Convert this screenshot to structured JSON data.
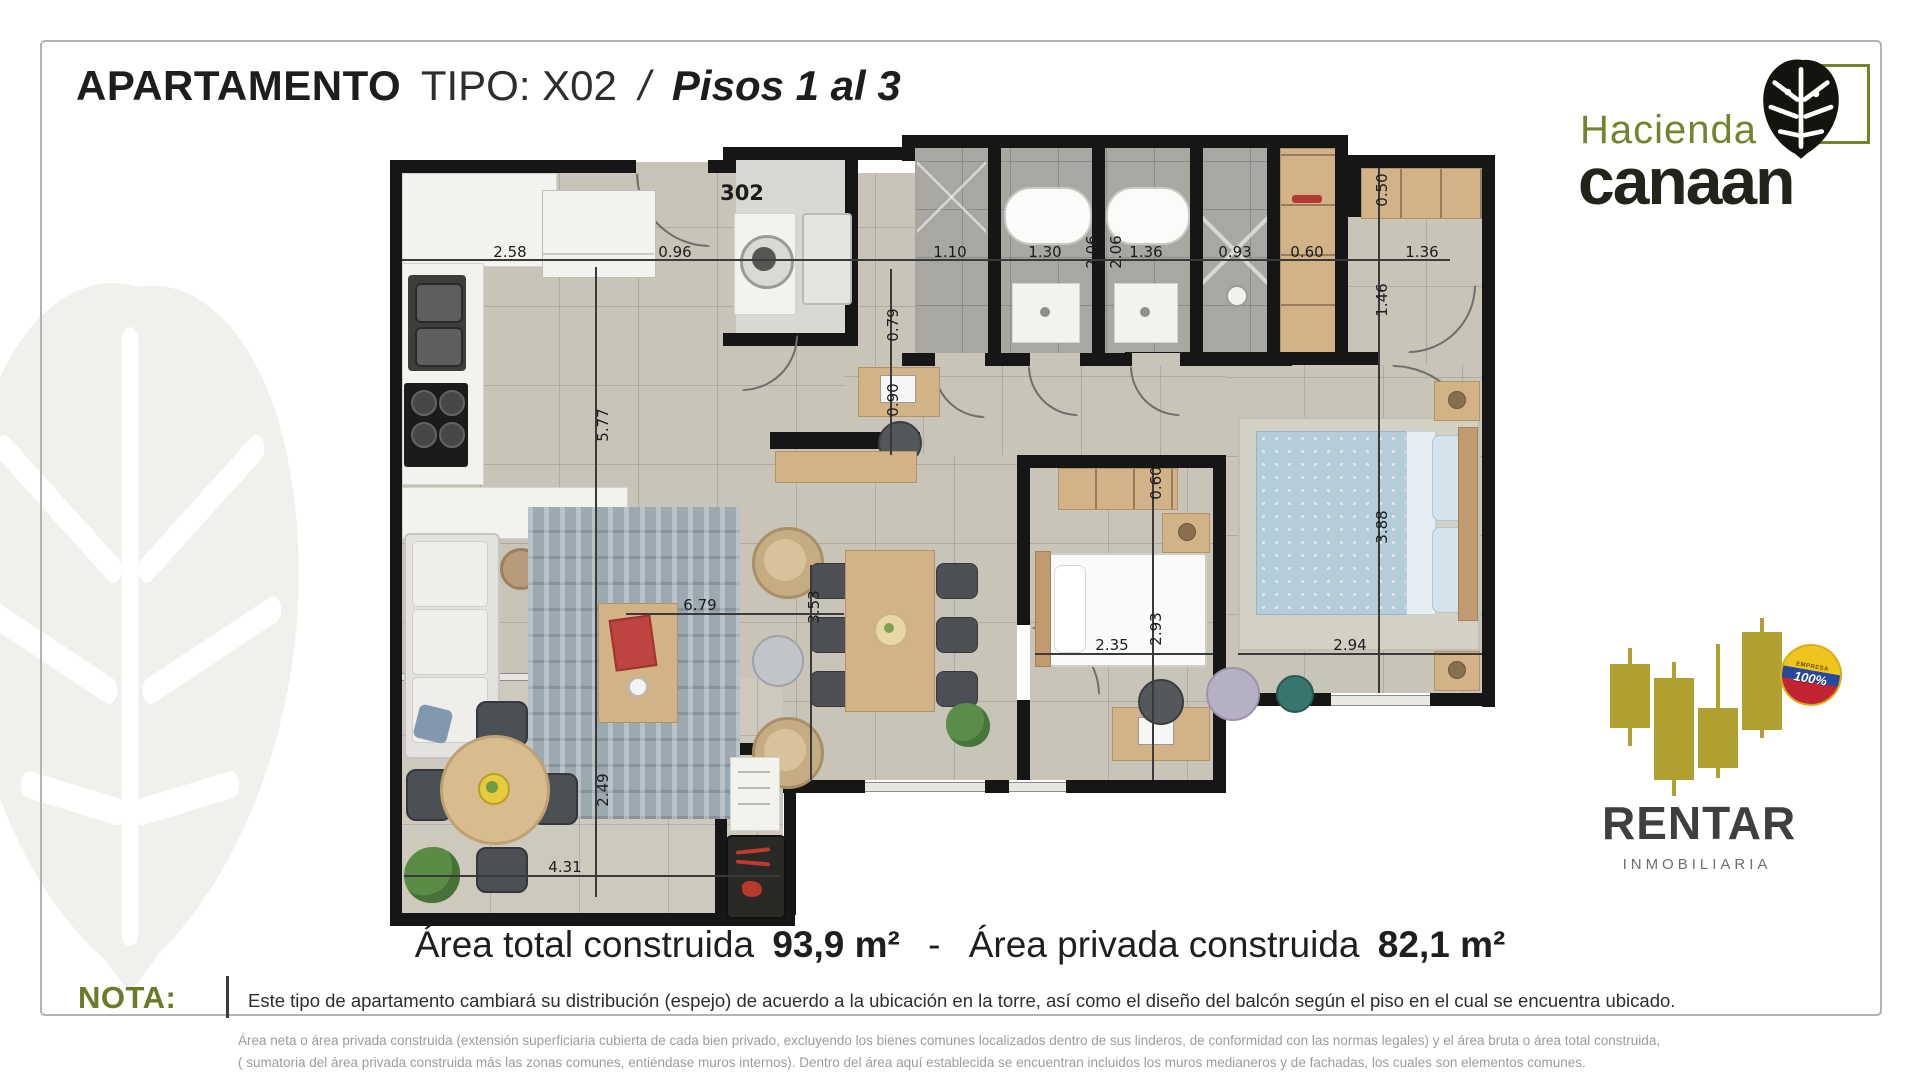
{
  "header": {
    "title_main": "APARTAMENTO",
    "title_type": "TIPO: X02",
    "title_sep": "/",
    "title_floors": "Pisos 1 al 3"
  },
  "brand": {
    "name_top": "Hacienda",
    "name_bottom": "canaan"
  },
  "plan": {
    "unit_label": "302",
    "dims": [
      {
        "v": "2.58"
      },
      {
        "v": "0.96"
      },
      {
        "v": "1.10"
      },
      {
        "v": "1.30"
      },
      {
        "v": "2.06"
      },
      {
        "v": "2.06"
      },
      {
        "v": "1.36"
      },
      {
        "v": "0.93"
      },
      {
        "v": "0.60"
      },
      {
        "v": "1.36"
      },
      {
        "v": "0.50"
      },
      {
        "v": "1.46"
      },
      {
        "v": "5.77"
      },
      {
        "v": "0.79"
      },
      {
        "v": "0.90"
      },
      {
        "v": "6.79"
      },
      {
        "v": "3.53"
      },
      {
        "v": "0.60"
      },
      {
        "v": "2.35"
      },
      {
        "v": "2.93"
      },
      {
        "v": "3.88"
      },
      {
        "v": "2.94"
      },
      {
        "v": "2.49"
      },
      {
        "v": "4.31"
      }
    ]
  },
  "summary": {
    "total_label": "Área total construida",
    "total_value": "93,9 m²",
    "separator": "-",
    "private_label": "Área privada construida",
    "private_value": "82,1 m²"
  },
  "nota": {
    "label": "NOTA:",
    "text": "Este tipo de apartamento cambiará su distribución (espejo) de acuerdo a la ubicación en la torre, así como el diseño del balcón según el piso en el cual se encuentra ubicado."
  },
  "legal": {
    "line1": "Área neta o área privada construida (extensión superficiaria cubierta de cada bien privado, excluyendo los bienes comunes localizados dentro de sus linderos, de conformidad con las normas legales) y el área bruta o área total construida,",
    "line2": "( sumatoria del área privada construida más las zonas comunes, entiéndase muros internos). Dentro del área aquí establecida  se encuentran incluidos los muros medianeros y de fachadas,  los cuales son elementos comunes."
  },
  "agency": {
    "name": "RENTAR",
    "subtitle": "INMOBILIARIA",
    "badge_top": "EMPRESA",
    "badge_value": "100%"
  },
  "colors": {
    "accent_olive": "#6f7e2c",
    "brand_dark": "#23231c",
    "agency_gold": "#b1a02f",
    "wall_black": "#161616"
  }
}
